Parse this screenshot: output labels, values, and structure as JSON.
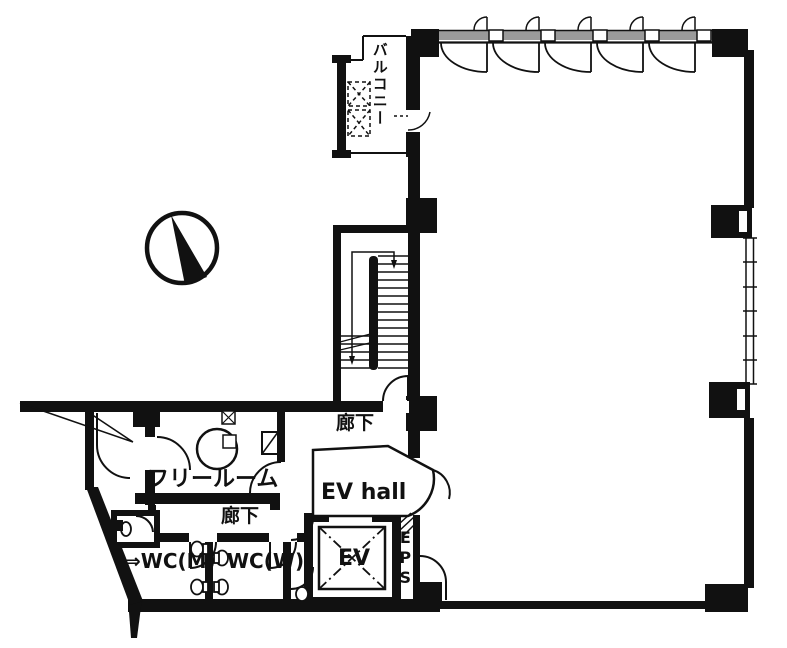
{
  "labels": {
    "balcony": "バルコニー",
    "corridor_upper": "廊下",
    "free_room": "フリールーム",
    "corridor_lower": "廊下",
    "ev_hall": "EV hall",
    "elevator": "EV",
    "eps": "EPS",
    "wc_men_arrow": "⇒",
    "wc_men": "WC(M)",
    "wc_women": "WC(W)"
  },
  "colors": {
    "wall": "#111111",
    "background": "#ffffff",
    "window_band": "#9a9a9a"
  }
}
